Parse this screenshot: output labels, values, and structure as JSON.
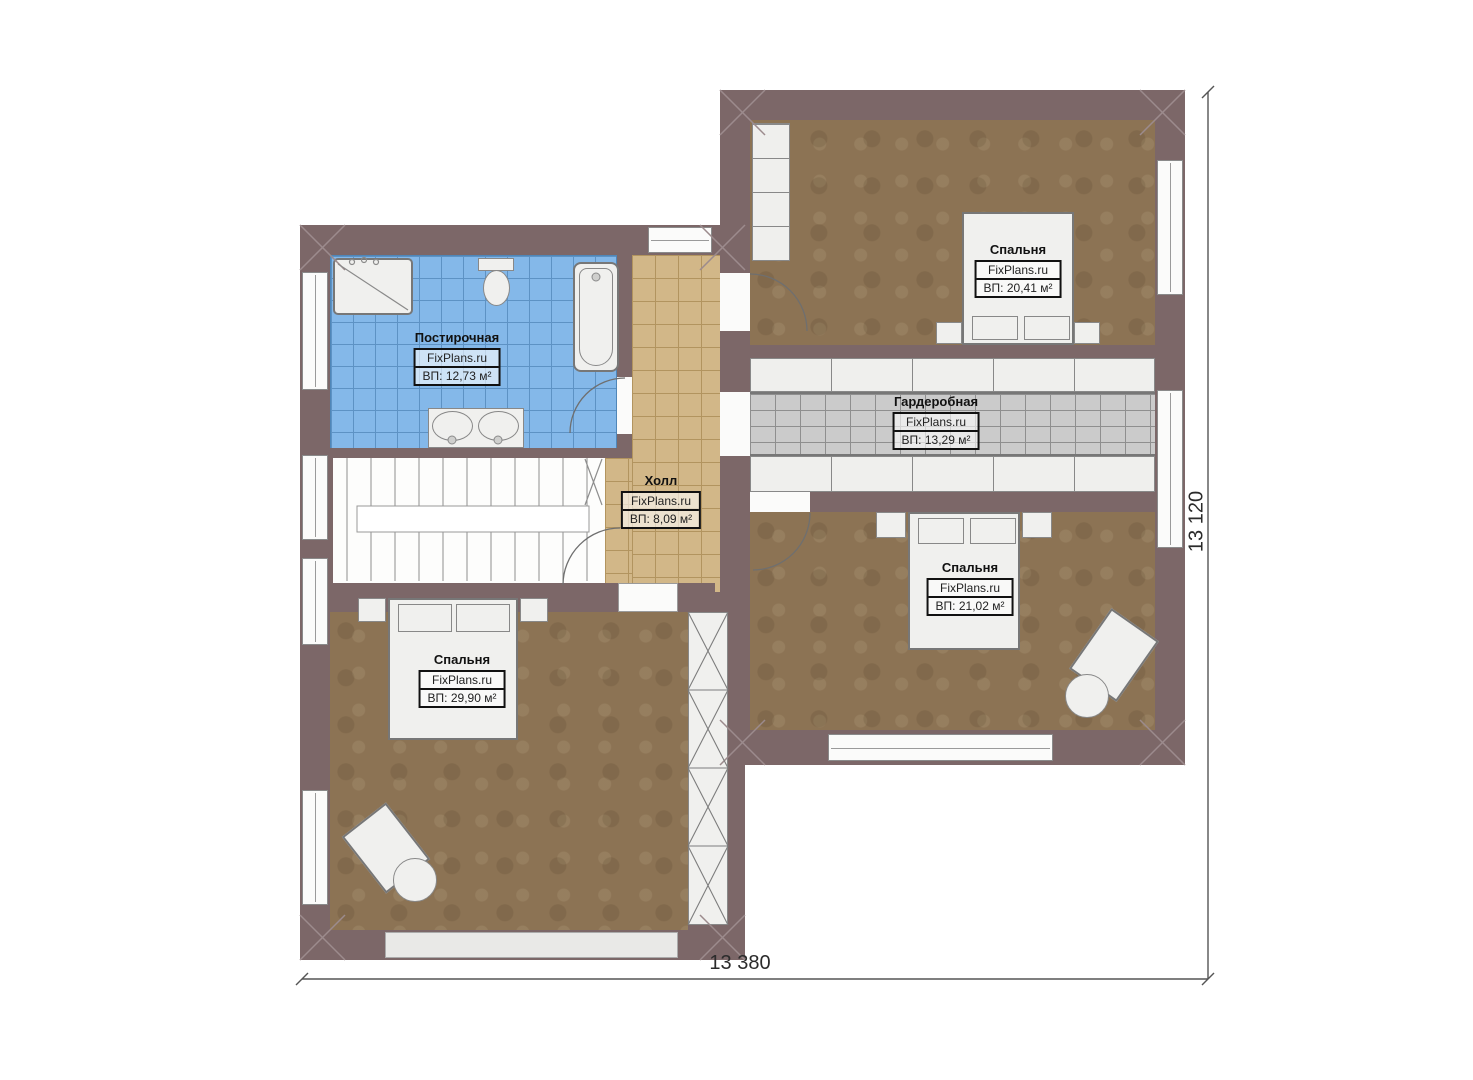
{
  "site": "FixPlans.ru",
  "rooms": [
    {
      "name": "Постирочная",
      "site": "FixPlans.ru",
      "area": "ВП: 12,73 м²"
    },
    {
      "name": "Холл",
      "site": "FixPlans.ru",
      "area": "ВП: 8,09 м²"
    },
    {
      "name": "Спальня",
      "site": "FixPlans.ru",
      "area": "ВП: 20,41 м²"
    },
    {
      "name": "Гардеробная",
      "site": "FixPlans.ru",
      "area": "ВП: 13,29 м²"
    },
    {
      "name": "Спальня",
      "site": "FixPlans.ru",
      "area": "ВП: 21,02 м²"
    },
    {
      "name": "Спальня",
      "site": "FixPlans.ru",
      "area": "ВП: 29,90 м²"
    }
  ],
  "dimensions": {
    "width": "13 380",
    "height": "13 120"
  },
  "colors": {
    "wall": "#7c6768",
    "floor_wood": "#8c7354",
    "bath_tile": "#84b8e9",
    "hall_tile": "#d2b788",
    "wardrobe_grid": "#cbcbcb",
    "furniture": "#f0f0ee"
  }
}
